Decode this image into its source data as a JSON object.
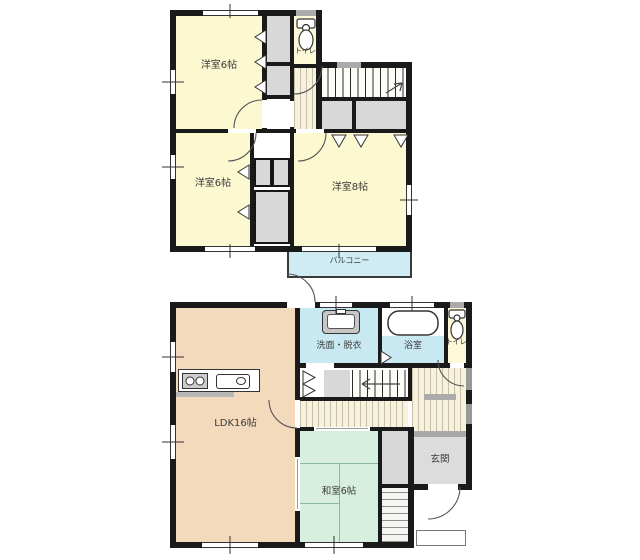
{
  "plan_title": "2-storey house floor plan",
  "floor2": {
    "bedroom_a": "洋室6帖",
    "bedroom_b": "洋室6帖",
    "bedroom_c": "洋室8帖",
    "toilet": "トイレ",
    "balcony": "バルコニー"
  },
  "floor1": {
    "ldk": "LDK16帖",
    "washroom": "洗面・脱衣",
    "bathroom": "浴室",
    "toilet": "トイレ",
    "japanese_room": "和室6帖",
    "entrance": "玄関"
  },
  "icons": [
    "toilet-icon",
    "bathtub-icon",
    "washbasin-icon",
    "stove-burners-icon",
    "kitchen-sink-icon",
    "stairs-icon",
    "door-swing-arc-icon",
    "bifold-door-icon",
    "window-icon"
  ],
  "colors": {
    "wall": "#1A1A1A",
    "bedroom_fill": "#FCF8D0",
    "ldk_fill": "#F3DABC",
    "japanese_room_fill": "#D6EFDE",
    "water_area_fill": "#C9E9F2",
    "balcony_fill": "#CFECF4",
    "toilet_fill": "#FCF8D8",
    "closet_fill": "#D8D8D8",
    "entrance_fill": "#DCDCDC"
  }
}
